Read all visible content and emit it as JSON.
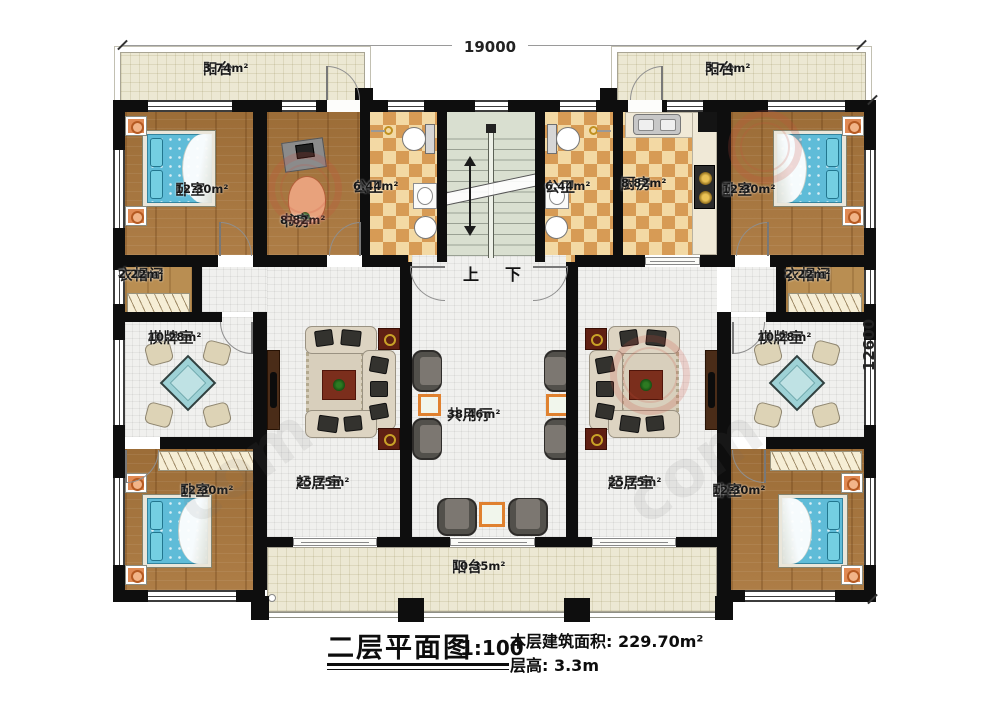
{
  "title": {
    "text": "二层平面图",
    "scale": "1:100",
    "building_area": "本层建筑面积: 229.70m²",
    "floor_height": "层高: 3.3m"
  },
  "dimensions": {
    "width": "19000",
    "height": "12600"
  },
  "stairs": {
    "up": "上",
    "down": "下"
  },
  "watermark": {
    "text": "com"
  },
  "rooms": {
    "balcony_tl": {
      "name": "阳台",
      "area": "3.74m²"
    },
    "balcony_tr": {
      "name": "阳台",
      "area": "3.74m²"
    },
    "bedroom_tl": {
      "name": "卧室",
      "area": "12.30m²"
    },
    "study": {
      "name": "书房",
      "area": "8.82m²"
    },
    "bath_l": {
      "name": "公卫",
      "area": "6.44m²"
    },
    "bath_r": {
      "name": "公卫",
      "area": "6.44m²"
    },
    "kitchen": {
      "name": "厨房",
      "area": "8.82m²"
    },
    "bedroom_tr": {
      "name": "卧室",
      "area": "12.30m²"
    },
    "cloak_l": {
      "name": "衣帽间",
      "area": "2.22m²"
    },
    "cloak_r": {
      "name": "衣帽间",
      "area": "2.22m²"
    },
    "chess_l": {
      "name": "棋牌室",
      "area": "10.28m²"
    },
    "chess_r": {
      "name": "棋牌室",
      "area": "10.28m²"
    },
    "living_l": {
      "name": "起居室",
      "area": "25.75m²"
    },
    "living_r": {
      "name": "起居室",
      "area": "25.75m²"
    },
    "hall": {
      "name": "共用厅",
      "area": "38.46m²"
    },
    "bedroom_bl": {
      "name": "卧室",
      "area": "12.30m²"
    },
    "bedroom_br": {
      "name": "卧室",
      "area": "12.30m²"
    },
    "balcony_b": {
      "name": "阳台",
      "area": "10.35m²"
    }
  }
}
